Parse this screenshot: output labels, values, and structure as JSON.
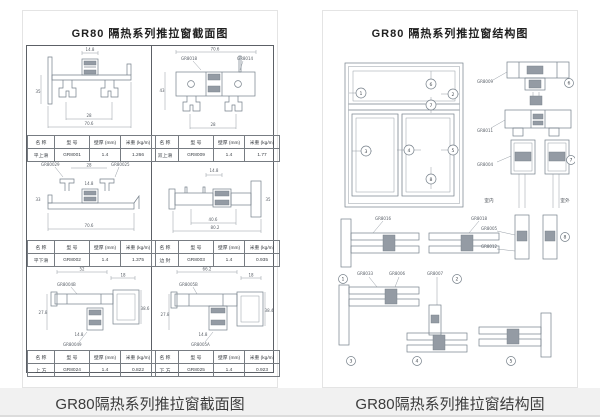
{
  "captions": {
    "left": "GR80隔热系列推拉窗截面图",
    "right": "GR80隔热系列推拉窗结构固"
  },
  "left_panel": {
    "title": "GR80 隔热系列推拉窗截面图",
    "headers": {
      "name": "名  称",
      "model": "型  号",
      "thickness": "壁厚 (mm)",
      "weight": "米重 (kg/m)"
    },
    "profiles": [
      {
        "name": "平上滑",
        "model": "GR8001",
        "thickness": "1.4",
        "weight": "1.266"
      },
      {
        "name": "双上滑",
        "model": "GR8009",
        "thickness": "1.4",
        "weight": "1.77"
      },
      {
        "name": "平下滑",
        "model": "GR8002",
        "thickness": "1.4",
        "weight": "1.375"
      },
      {
        "name": "边 封",
        "model": "GR8003",
        "thickness": "1.4",
        "weight": "0.935"
      },
      {
        "name": "上 方",
        "model": "GR8024",
        "thickness": "1.4",
        "weight": "0.822"
      },
      {
        "name": "下 方",
        "model": "GR8025",
        "thickness": "1.4",
        "weight": "0.923"
      }
    ],
    "drawings": {
      "d1": {
        "dim_top": "14.8",
        "dim_mid": "28",
        "dim_bottom": "70.6",
        "dim_left": "35"
      },
      "d2": {
        "callout_left": "GR8018",
        "callout_right": "GR8014",
        "dim_top": "70.6",
        "dim_left": "43",
        "dim_bottom": "28"
      },
      "d3": {
        "callout_left": "GR80029",
        "callout_right": "GR80025",
        "dim_top": "28",
        "dim_mid": "14.8",
        "dim_bottom": "70.6",
        "dim_left": "33"
      },
      "d4": {
        "dim_top": "14.8",
        "dim_mid": "40.6",
        "dim_bottom": "80.2",
        "dim_right": "35"
      },
      "d5": {
        "dim_top": "52",
        "dim_right_top": "18",
        "dim_left": "27.8",
        "dim_mid": "14.8",
        "dim_right": "38.6",
        "callout_top": "GR8004B",
        "callout_bottom": "GR80049"
      },
      "d6": {
        "dim_top": "66.2",
        "dim_right_top": "18",
        "dim_left": "27.8",
        "dim_mid": "14.8",
        "dim_right": "38.4",
        "callout_top": "GR8005B",
        "callout_bottom": "GR8005A"
      }
    }
  },
  "right_panel": {
    "title": "GR80 隔热系列推拉窗结构图",
    "elevation": {
      "m1": "1",
      "m2": "2",
      "m3": "3",
      "m4": "4",
      "m5": "5",
      "m6": "6",
      "m7": "7",
      "m8": "8"
    },
    "stack": {
      "c1": "GR8009",
      "c2": "GR8011",
      "c3": "GR8004",
      "m6": "6",
      "m7": "7",
      "room_left": "室内",
      "room_right": "室外"
    },
    "bottom": {
      "c1": "GR8016",
      "c2": "GR8018",
      "c3": "GR8005",
      "c4": "GR8012",
      "c5": "GR8033",
      "c6": "GR8006",
      "c7": "GR8007",
      "m1": "1",
      "m2": "2",
      "m3": "3",
      "m4": "4",
      "m5": "5",
      "m8": "8"
    }
  }
}
